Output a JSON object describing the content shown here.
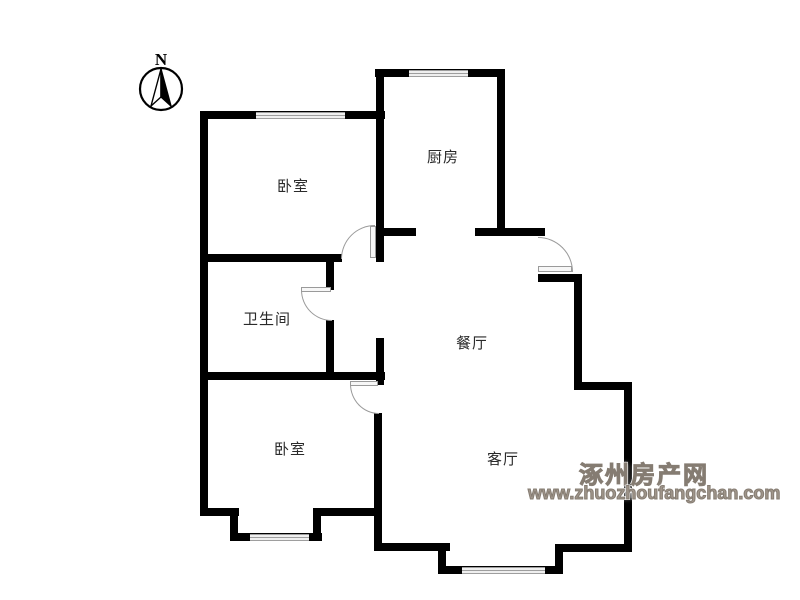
{
  "floor_plan": {
    "compass": {
      "label": "N"
    },
    "rooms": [
      {
        "id": "bedroom-top",
        "label": "卧室"
      },
      {
        "id": "kitchen",
        "label": "厨房"
      },
      {
        "id": "bathroom",
        "label": "卫生间"
      },
      {
        "id": "dining-room",
        "label": "餐厅"
      },
      {
        "id": "bedroom-bottom",
        "label": "卧室"
      },
      {
        "id": "living-room",
        "label": "客厅"
      }
    ]
  },
  "watermark": {
    "site_name": "涿州房产网",
    "site_url": "www.zhuozhoufangchan.com"
  },
  "colors": {
    "wall": "#000000",
    "window_line": "#9e9e9e",
    "door": "#9a9a9a",
    "watermark": "#8b8178",
    "label_text": "#2a2a2a",
    "background": "#ffffff"
  }
}
